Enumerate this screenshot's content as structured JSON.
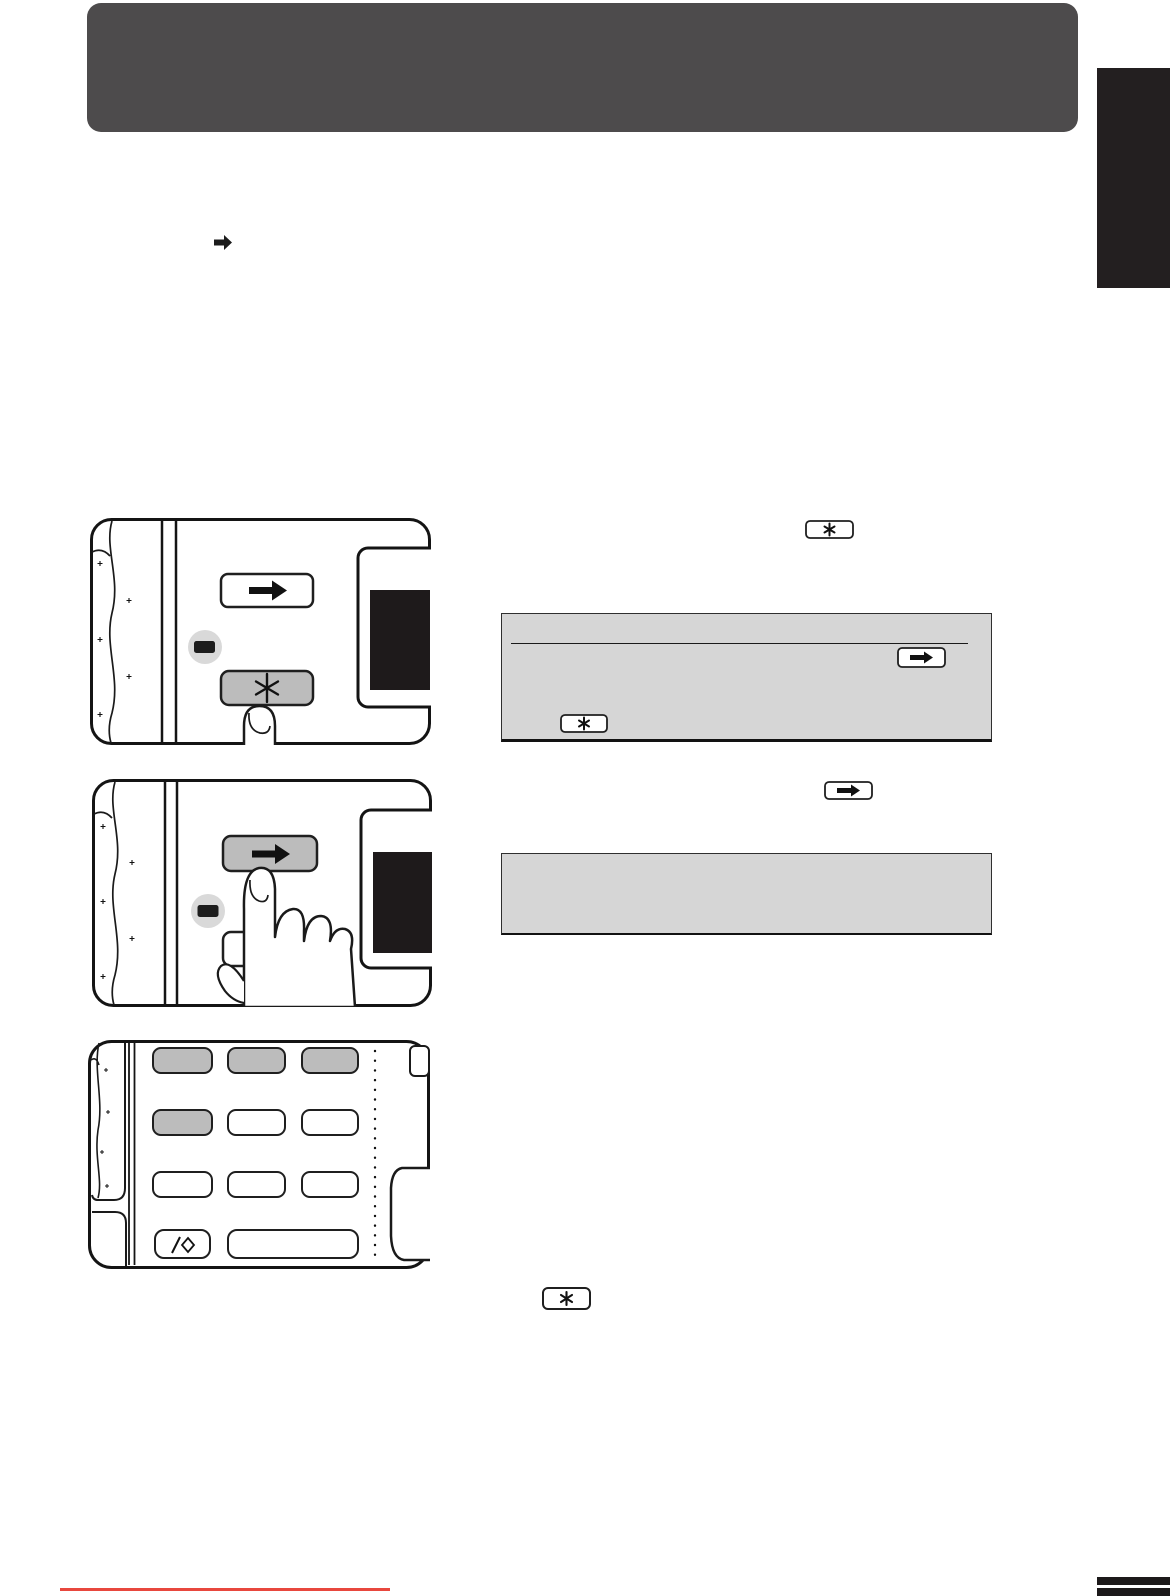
{
  "page": {
    "width": 1170,
    "height": 1596,
    "background": "#ffffff"
  },
  "colors": {
    "header_bg": "#4d4b4c",
    "side_tab_bg": "#231f20",
    "box_gray": "#d6d6d6",
    "key_gray": "#bcbcbc",
    "key_white": "#ffffff",
    "led_circle_gray": "#d9d9d9",
    "led_dark": "#1c1c1c",
    "screen_black": "#1e1a1b",
    "line_dark": "#1a1a1a",
    "red_rule": "#e8473e",
    "footer_bar": "#1c191a"
  },
  "icons": {
    "arrow_right_key": "➡",
    "asterisk_key": "✳",
    "slash_diamond_key": "/◇",
    "led_indicator": "▬"
  },
  "inline_callouts": {
    "intro_arrow_glyph": "➡",
    "step1_key_glyph": "✳",
    "step2_key_glyph": "➡",
    "step3_key_glyph": "✳"
  },
  "note_box_1": {
    "has_divider_line": true,
    "keys_shown": [
      "➡",
      "✳"
    ]
  },
  "note_box_2": {
    "keys_shown": []
  },
  "diagrams": {
    "panel_step1": {
      "keys": [
        {
          "name": "arrow-right-key",
          "state": "normal"
        },
        {
          "name": "asterisk-key",
          "state": "highlighted-pressed-by-finger"
        }
      ],
      "indicator": "led-lamp",
      "display": "dark-screen"
    },
    "panel_step2": {
      "keys": [
        {
          "name": "arrow-right-key",
          "state": "highlighted-pressed-by-finger"
        },
        {
          "name": "asterisk-key",
          "state": "normal"
        }
      ],
      "indicator": "led-lamp",
      "display": "dark-screen"
    },
    "panel_step3_keypad": {
      "rows": [
        [
          "highlighted",
          "highlighted",
          "highlighted"
        ],
        [
          "highlighted",
          "normal",
          "normal"
        ],
        [
          "normal",
          "normal",
          "normal"
        ],
        [
          "slash-diamond",
          "wide-normal"
        ]
      ]
    }
  }
}
